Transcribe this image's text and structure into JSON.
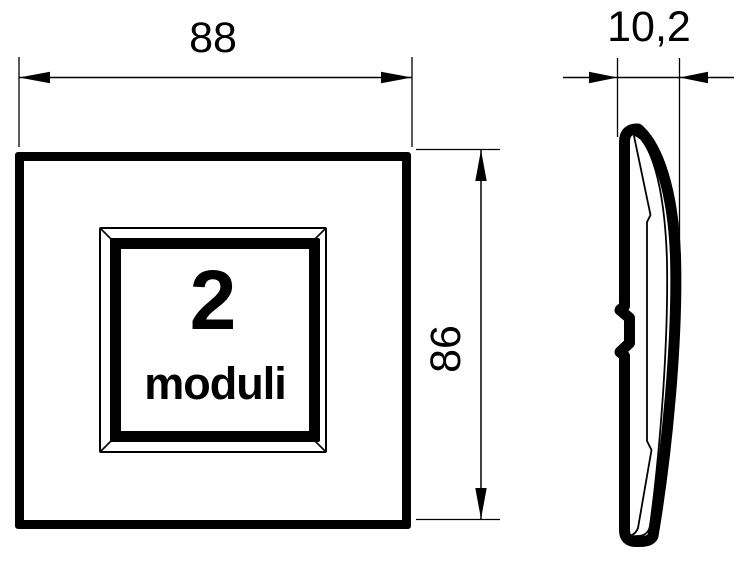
{
  "front_view": {
    "module_count": "2",
    "module_label": "moduli",
    "width_dimension": "88",
    "height_dimension": "86"
  },
  "side_view": {
    "depth_dimension": "10,2"
  },
  "colors": {
    "line": "#000000",
    "background": "#ffffff"
  }
}
